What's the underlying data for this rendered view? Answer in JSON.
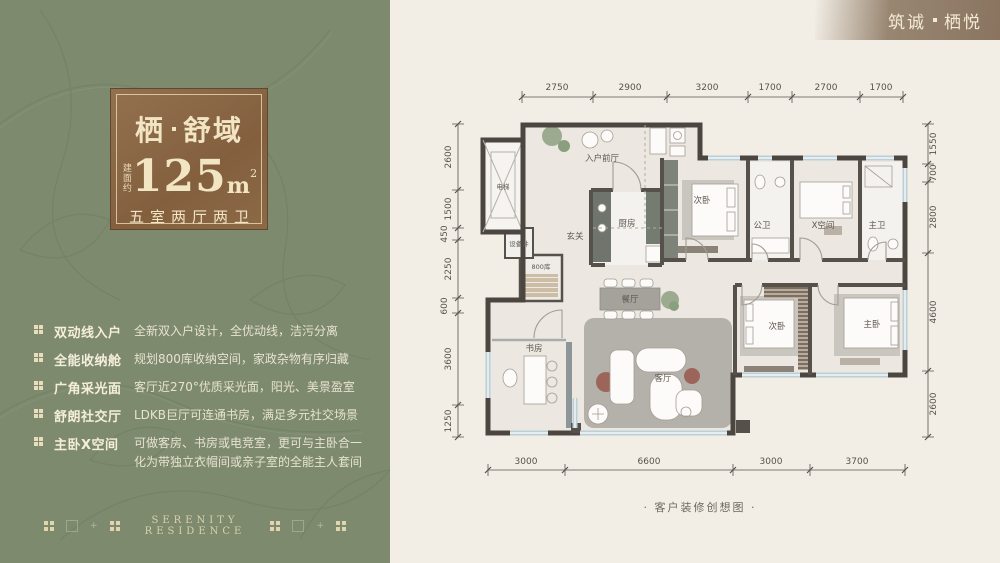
{
  "brand": {
    "part1": "筑诚",
    "part2": "栖悦"
  },
  "badge": {
    "title1": "栖",
    "title2": "舒域",
    "area_prefix": "建面约",
    "area_number": "125",
    "area_unit": "m",
    "area_exp": "2",
    "rooms": "五室两厅两卫"
  },
  "features": [
    {
      "label": "双动线入户",
      "desc": "全新双入户设计，全优动线，洁污分离"
    },
    {
      "label": "全能收纳舱",
      "desc": "规划800库收纳空间，家政杂物有序归藏"
    },
    {
      "label": "广角采光面",
      "desc": "客厅近270°优质采光面，阳光、美景盈室"
    },
    {
      "label": "舒朗社交厅",
      "desc": "LDKB巨厅可连通书房，满足多元社交场景"
    },
    {
      "label": "主卧X空间",
      "desc": "可做客房、书房或电竞室，更可与主卧合一化为带独立衣帽间或亲子室的全能主人套间"
    }
  ],
  "footer": {
    "en": "SERENITY RESIDENCE"
  },
  "plan": {
    "caption": "· 客户装修创想图 ·",
    "rooms": {
      "elevator": "电梯",
      "foyer": "入户前厅",
      "hall": "玄关",
      "shaft": "设备井",
      "storage": "800库",
      "kitchen": "厨房",
      "bedroom2_top": "次卧",
      "bath_public": "公卫",
      "x_space": "X空间",
      "bath_master": "主卫",
      "study": "书房",
      "dining": "餐厅",
      "living": "客厅",
      "bedroom2_bottom": "次卧",
      "master": "主卧"
    },
    "dims": {
      "top": [
        "2750",
        "2900",
        "3200",
        "1700",
        "2700",
        "1700"
      ],
      "left": [
        "2600",
        "1500",
        "450",
        "2250",
        "600",
        "3600",
        "1250"
      ],
      "right": [
        "1550",
        "700",
        "2800",
        "4600",
        "2600"
      ],
      "bottom": [
        "3000",
        "6600",
        "3000",
        "3700"
      ]
    }
  },
  "colors": {
    "panel_green": "#7d8a6e",
    "badge_brown": "#8a6847",
    "cream_bg": "#f2eee6",
    "cream_text": "#f2e5c4",
    "wall_dark": "#4c4640",
    "window_blue": "#bccfd6",
    "accent_terracotta": "#9b655a"
  }
}
